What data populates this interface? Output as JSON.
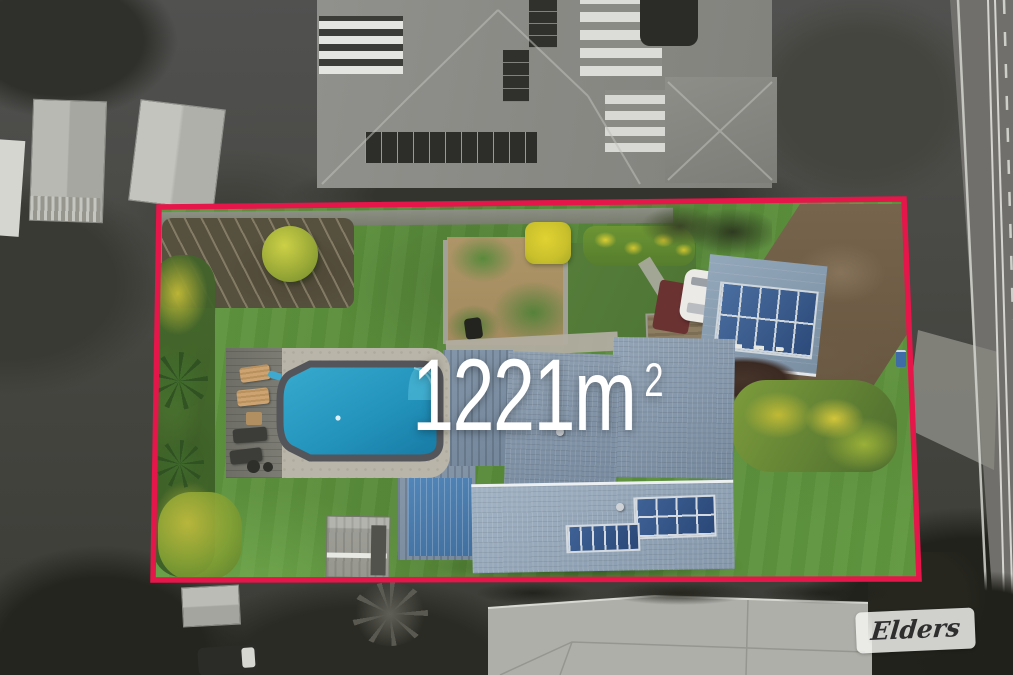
{
  "image_type": "aerial-property-photograph",
  "annotation": {
    "land_area_value": "1221m",
    "land_area_superscript": "2",
    "land_area_full": "1221m²"
  },
  "watermark": {
    "brand_name": "Elders"
  },
  "boundary": {
    "points": "159,207 904,199 919,579 153,580",
    "color": "#e5164a",
    "stroke_width": "5.5"
  },
  "palette": {
    "lawn_green": "#639c41",
    "roof_blue_gray": "#8095a9",
    "patio_roof_blue": "#4c80b4",
    "pool_water": "#2aa3c8",
    "pool_coping": "#54555a",
    "paving": "#b9b5a8",
    "solar_panel": "#35568c",
    "driveway_soil": "#75624a",
    "surroundings_gray": "#6f6f6b",
    "watermark_background": "#f5f5f3"
  },
  "scene_features": [
    "property lot shown in colour inside red boundary outline",
    "greyscale surroundings",
    "swimming pool with paved surround and sun loungers",
    "main house with blue-grey roofs and rooftop solar panels",
    "detached garage with ten-panel solar array",
    "garden shed on lawn",
    "garden beds with yellow flowering shrubs",
    "dirt driveway at right",
    "caravan parked beside deck",
    "neighbouring house roofs above and below",
    "road with white line markings at top right"
  ]
}
